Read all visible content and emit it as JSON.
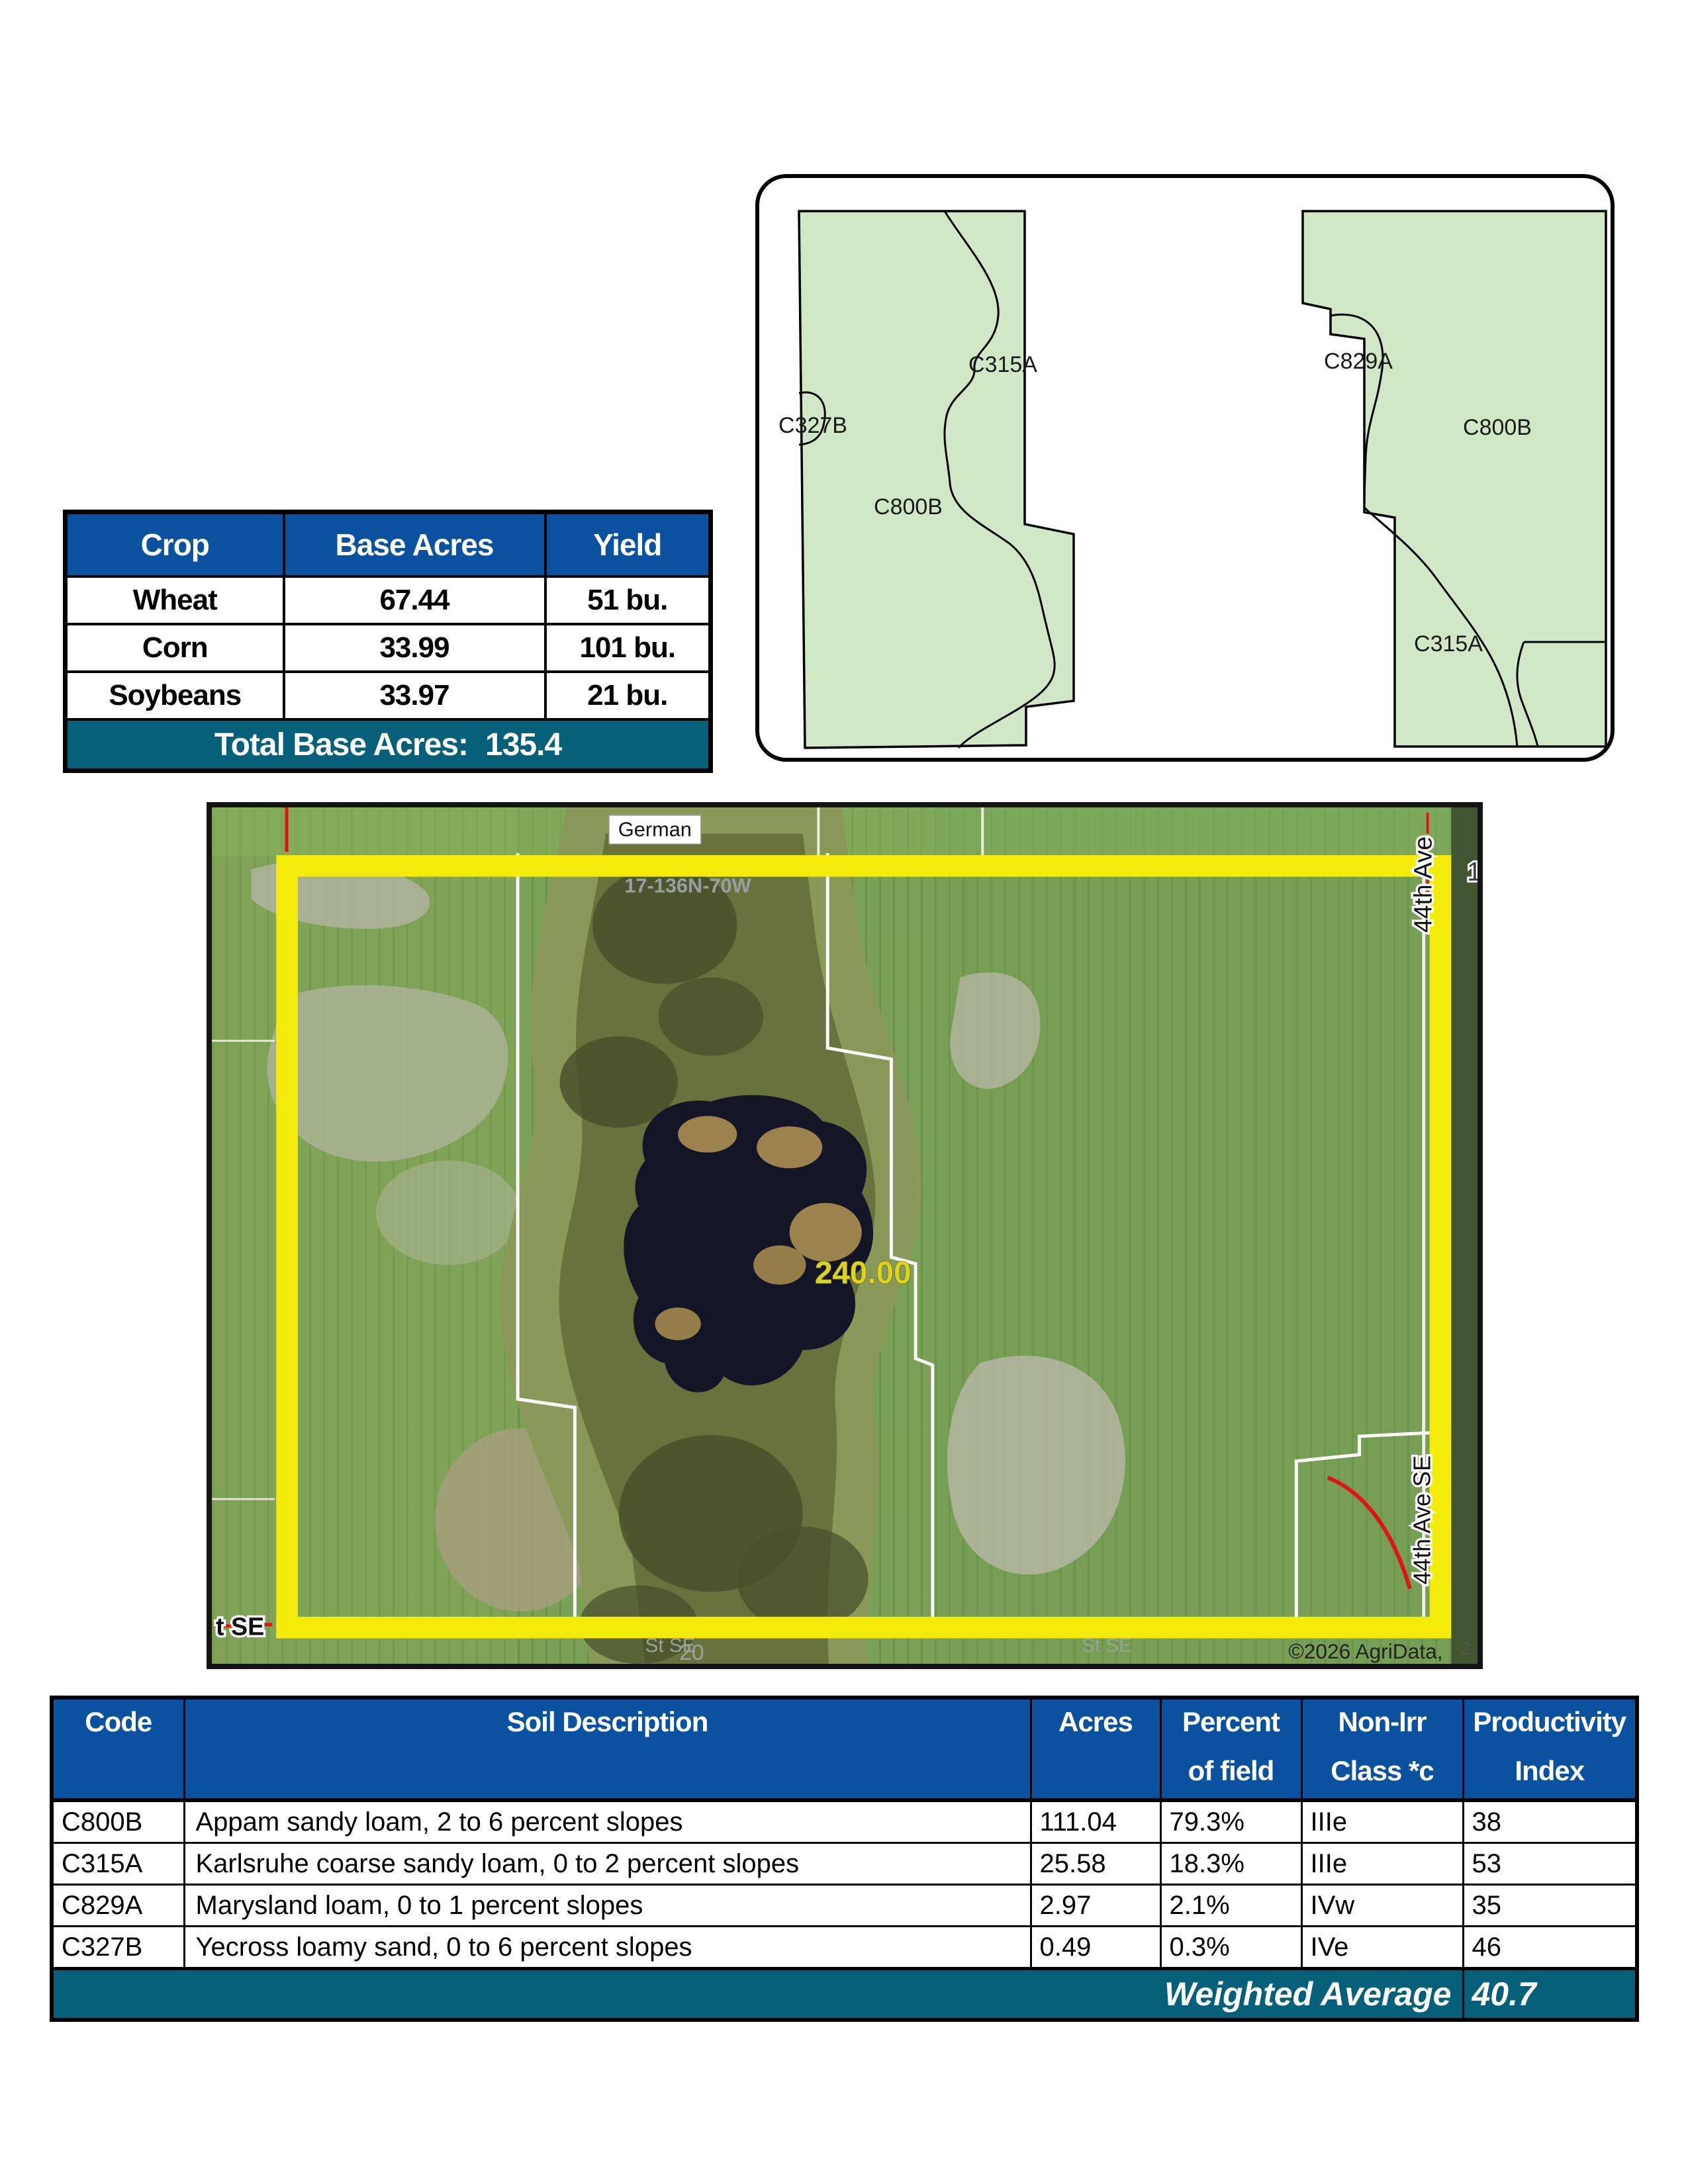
{
  "colors": {
    "header_blue": "#0a52a0",
    "footer_teal": "#06607a",
    "parcel_green": "#d0e8c5",
    "boundary_yellow": "#f4eb0b",
    "pond_dark": "#141627",
    "field_green": "#7aa156"
  },
  "crop_table": {
    "headers": [
      "Crop",
      "Base Acres",
      "Yield"
    ],
    "rows": [
      {
        "crop": "Wheat",
        "base_acres": "67.44",
        "yield": "51 bu."
      },
      {
        "crop": "Corn",
        "base_acres": "33.99",
        "yield": "101 bu."
      },
      {
        "crop": "Soybeans",
        "base_acres": "33.97",
        "yield": "21 bu."
      }
    ],
    "footer_label": "Total Base Acres:",
    "footer_value": "135.4"
  },
  "soil_map": {
    "left_parcel": {
      "labels": [
        {
          "text": "C315A"
        },
        {
          "text": "C327B"
        },
        {
          "text": "C800B"
        }
      ]
    },
    "right_parcel": {
      "labels": [
        {
          "text": "C829A"
        },
        {
          "text": "C800B"
        },
        {
          "text": "C315A"
        }
      ]
    }
  },
  "aerial_map": {
    "road_top": "German",
    "township": "17-136N-70W",
    "acres": "240.00",
    "road_right_top": "44th Ave",
    "road_right_mid": "44th Ave SE",
    "corner_number": "1",
    "road_bottom_left": "t SE",
    "street_center": "St SE",
    "street_right": "St SE",
    "section_number": "20",
    "copyright": "©2026 AgriData,",
    "edge_number": "2"
  },
  "soil_table": {
    "headers": [
      {
        "line1": "Code",
        "line2": ""
      },
      {
        "line1": "Soil Description",
        "line2": ""
      },
      {
        "line1": "Acres",
        "line2": ""
      },
      {
        "line1": "Percent",
        "line2": "of field"
      },
      {
        "line1": "Non-Irr",
        "line2": "Class *c"
      },
      {
        "line1": "Productivity",
        "line2": "Index"
      }
    ],
    "rows": [
      {
        "code": "C800B",
        "description": "Appam sandy loam, 2 to 6 percent slopes",
        "acres": "111.04",
        "percent": "79.3%",
        "non_irr": "IIIe",
        "pi": "38"
      },
      {
        "code": "C315A",
        "description": "Karlsruhe coarse sandy loam, 0 to 2 percent slopes",
        "acres": "25.58",
        "percent": "18.3%",
        "non_irr": "IIIe",
        "pi": "53"
      },
      {
        "code": "C829A",
        "description": "Marysland loam, 0 to 1 percent slopes",
        "acres": "2.97",
        "percent": "2.1%",
        "non_irr": "IVw",
        "pi": "35"
      },
      {
        "code": "C327B",
        "description": "Yecross loamy sand, 0 to 6 percent slopes",
        "acres": "0.49",
        "percent": "0.3%",
        "non_irr": "IVe",
        "pi": "46"
      }
    ],
    "footer_label": "Weighted Average",
    "footer_value": "40.7"
  }
}
